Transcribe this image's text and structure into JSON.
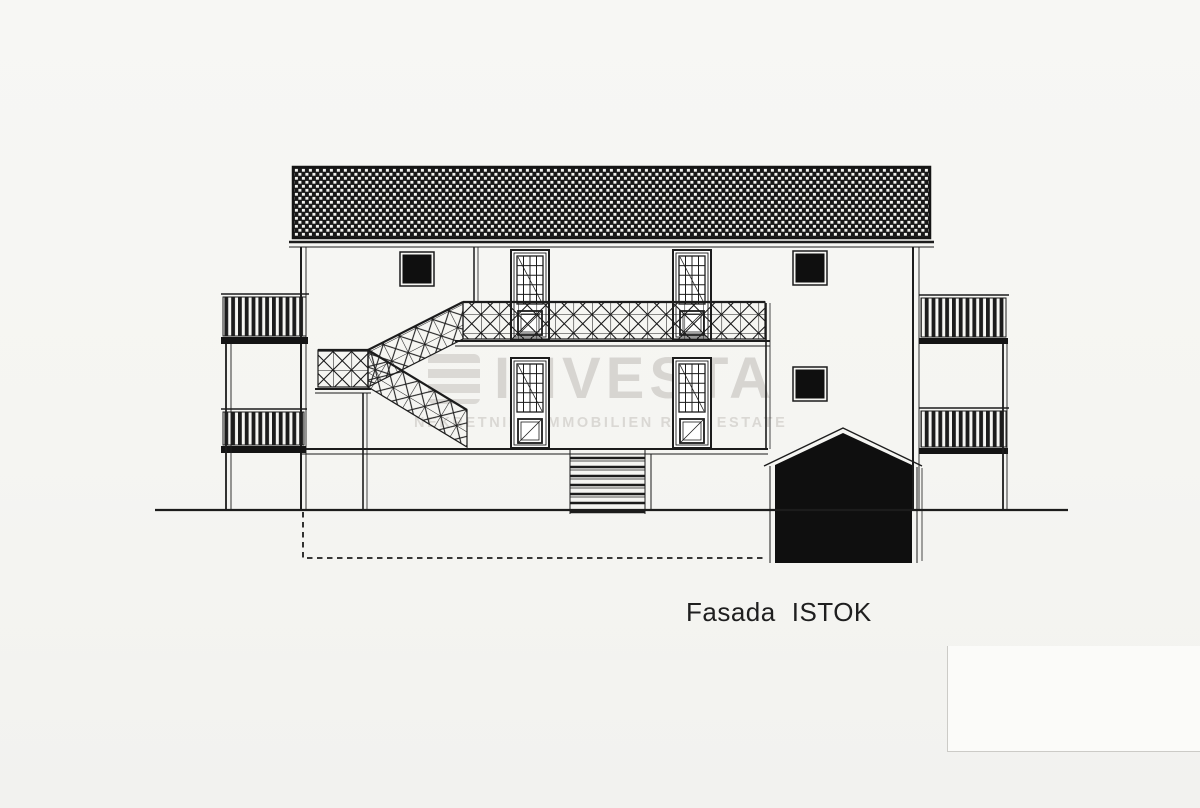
{
  "caption": {
    "word1": "Fasada",
    "word2": "ISTOK"
  },
  "watermark": {
    "brand": "INVESTA",
    "tagline": "NEKRETNINE IMMOBILIEN REAL ESTATE"
  },
  "colors": {
    "paper": "#f5f5f2",
    "ink": "#1c1c1c",
    "fill_black": "#0f0f0f",
    "watermark_gray": "#d6d4d0"
  }
}
